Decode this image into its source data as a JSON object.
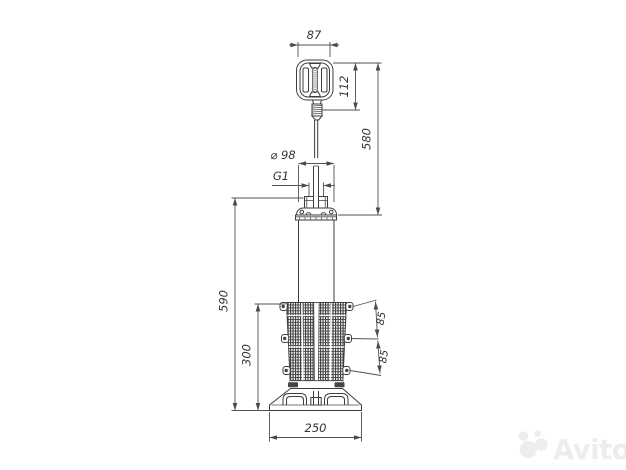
{
  "colors": {
    "background": "#ffffff",
    "line": "#3d3d3d",
    "dimension_line": "#525252",
    "text": "#333333",
    "mesh": "#404040",
    "watermark": "#ededed"
  },
  "dimensions": {
    "float_width": "87",
    "float_height": "112",
    "float_to_pump_top": "580",
    "pump_diameter": "⌀ 98",
    "outlet_thread": "G1",
    "overall_height": "590",
    "strainer_height": "300",
    "clip_spacing_upper": "85",
    "clip_spacing_lower": "85",
    "base_width": "250"
  },
  "watermark": {
    "brand": "Avito"
  }
}
